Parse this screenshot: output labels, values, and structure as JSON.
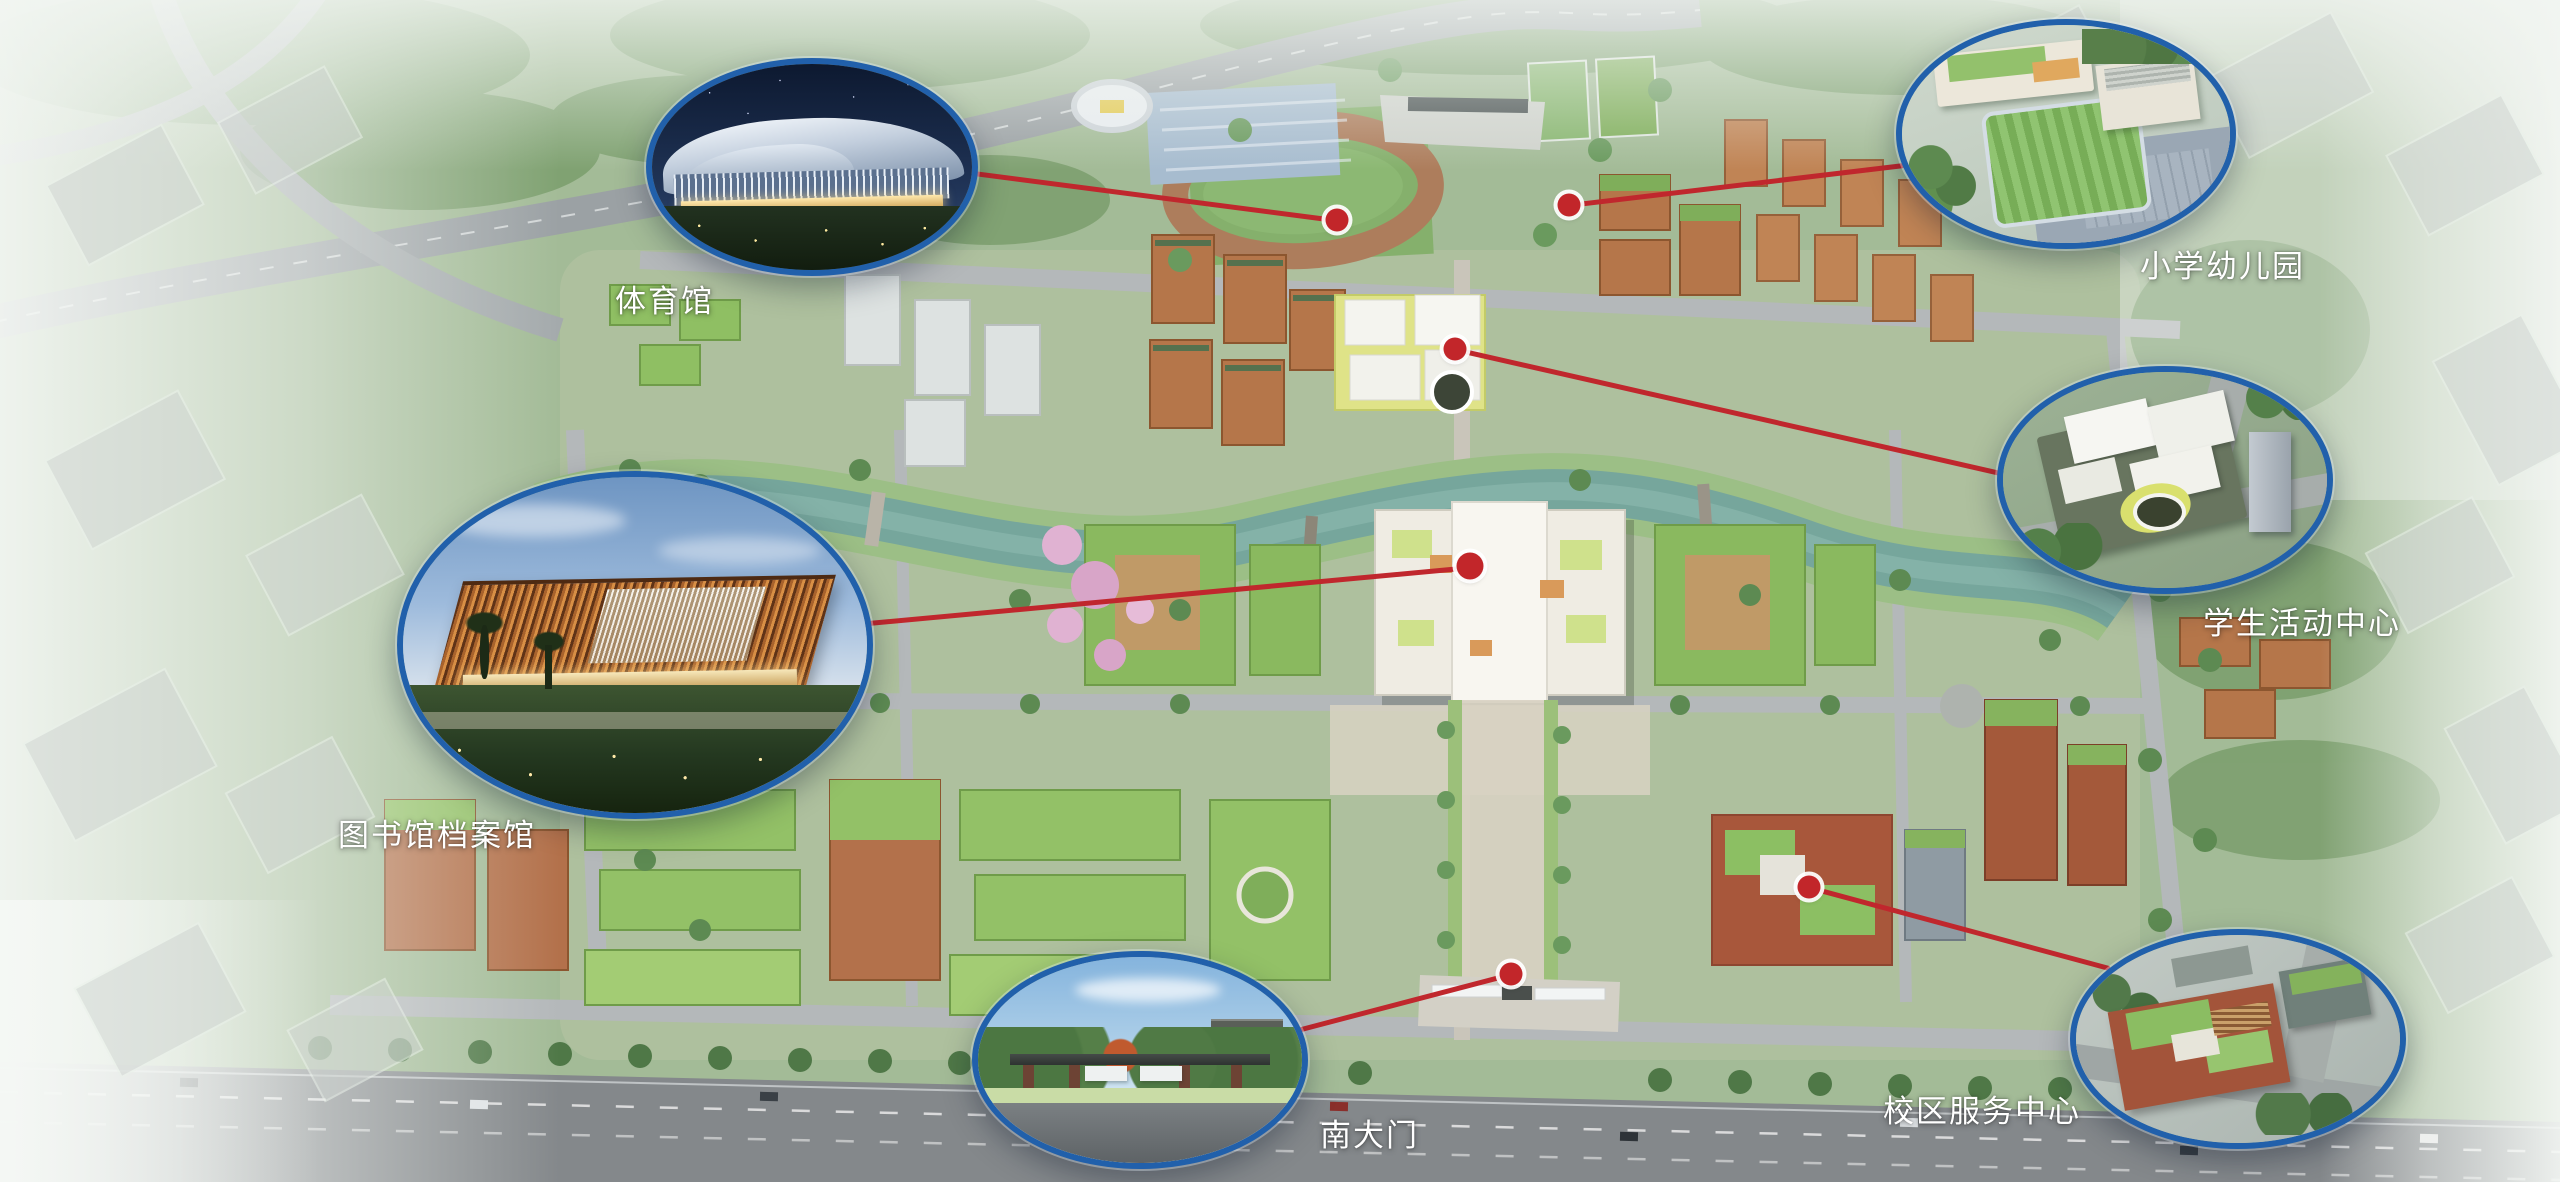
{
  "map": {
    "type": "campus-master-plan-aerial-rendering",
    "callouts": [
      {
        "id": "gymnasium",
        "label": "体育馆"
      },
      {
        "id": "primary-school-kindergarten",
        "label": "小学幼儿园"
      },
      {
        "id": "student-activity-center",
        "label": "学生活动中心"
      },
      {
        "id": "library-archives",
        "label": "图书馆档案馆"
      },
      {
        "id": "south-gate",
        "label": "南大门"
      },
      {
        "id": "campus-service-center",
        "label": "校区服务中心"
      }
    ],
    "colors": {
      "callout_border": "#2160ab",
      "connector": "#c0272d",
      "marker": "#c2262a",
      "marker_ring": "#ffffff",
      "label_text": "#ffffff",
      "water": "#76a69c",
      "green_roof": "#93c167",
      "brick": "#b5764a"
    }
  }
}
